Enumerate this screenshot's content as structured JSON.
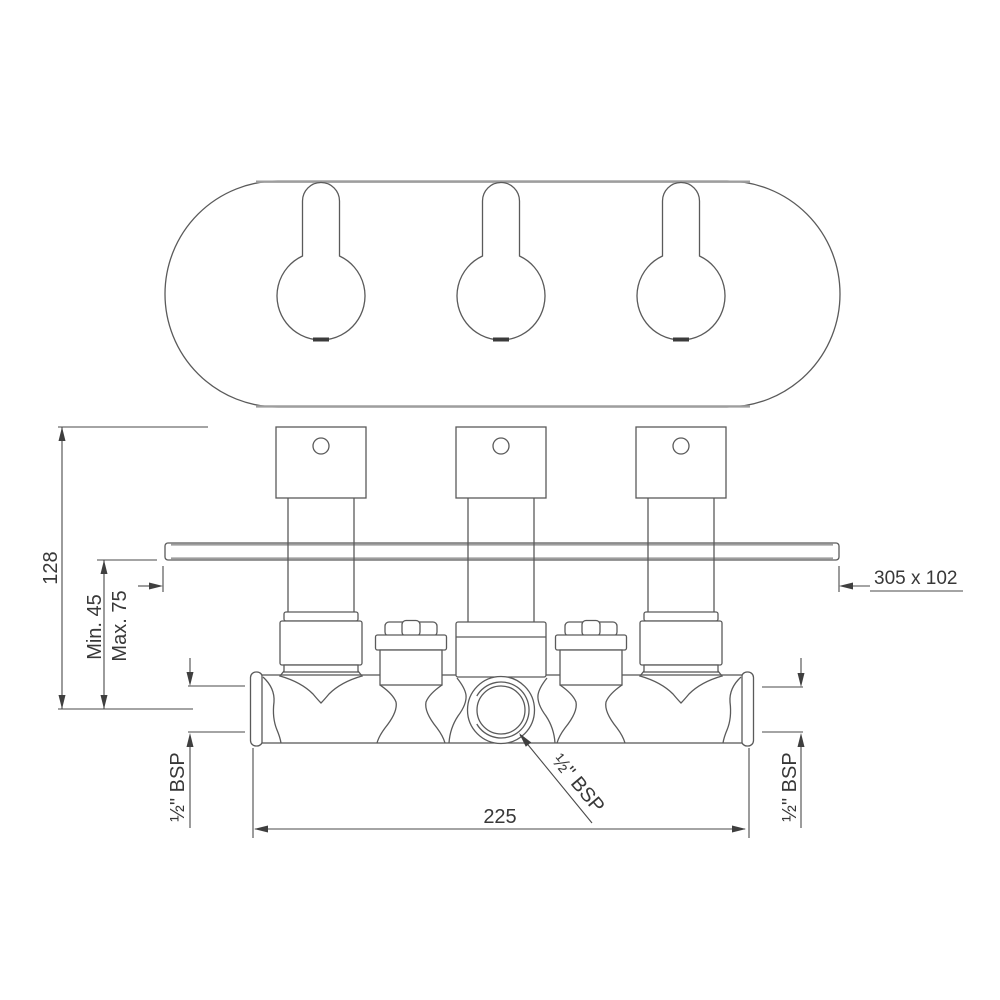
{
  "drawing": {
    "background": "#ffffff",
    "line_color": "#5a5a5a",
    "text_color": "#383838",
    "dimensions": {
      "overall_height": "128",
      "min_depth": "Min. 45",
      "max_depth": "Max. 75",
      "plate_size": "305 x 102",
      "inlet_centers": "225",
      "left_inlet_thread": "½\" BSP",
      "outlet_thread": "½\" BSP",
      "right_inlet_thread": "½\" BSP"
    }
  }
}
